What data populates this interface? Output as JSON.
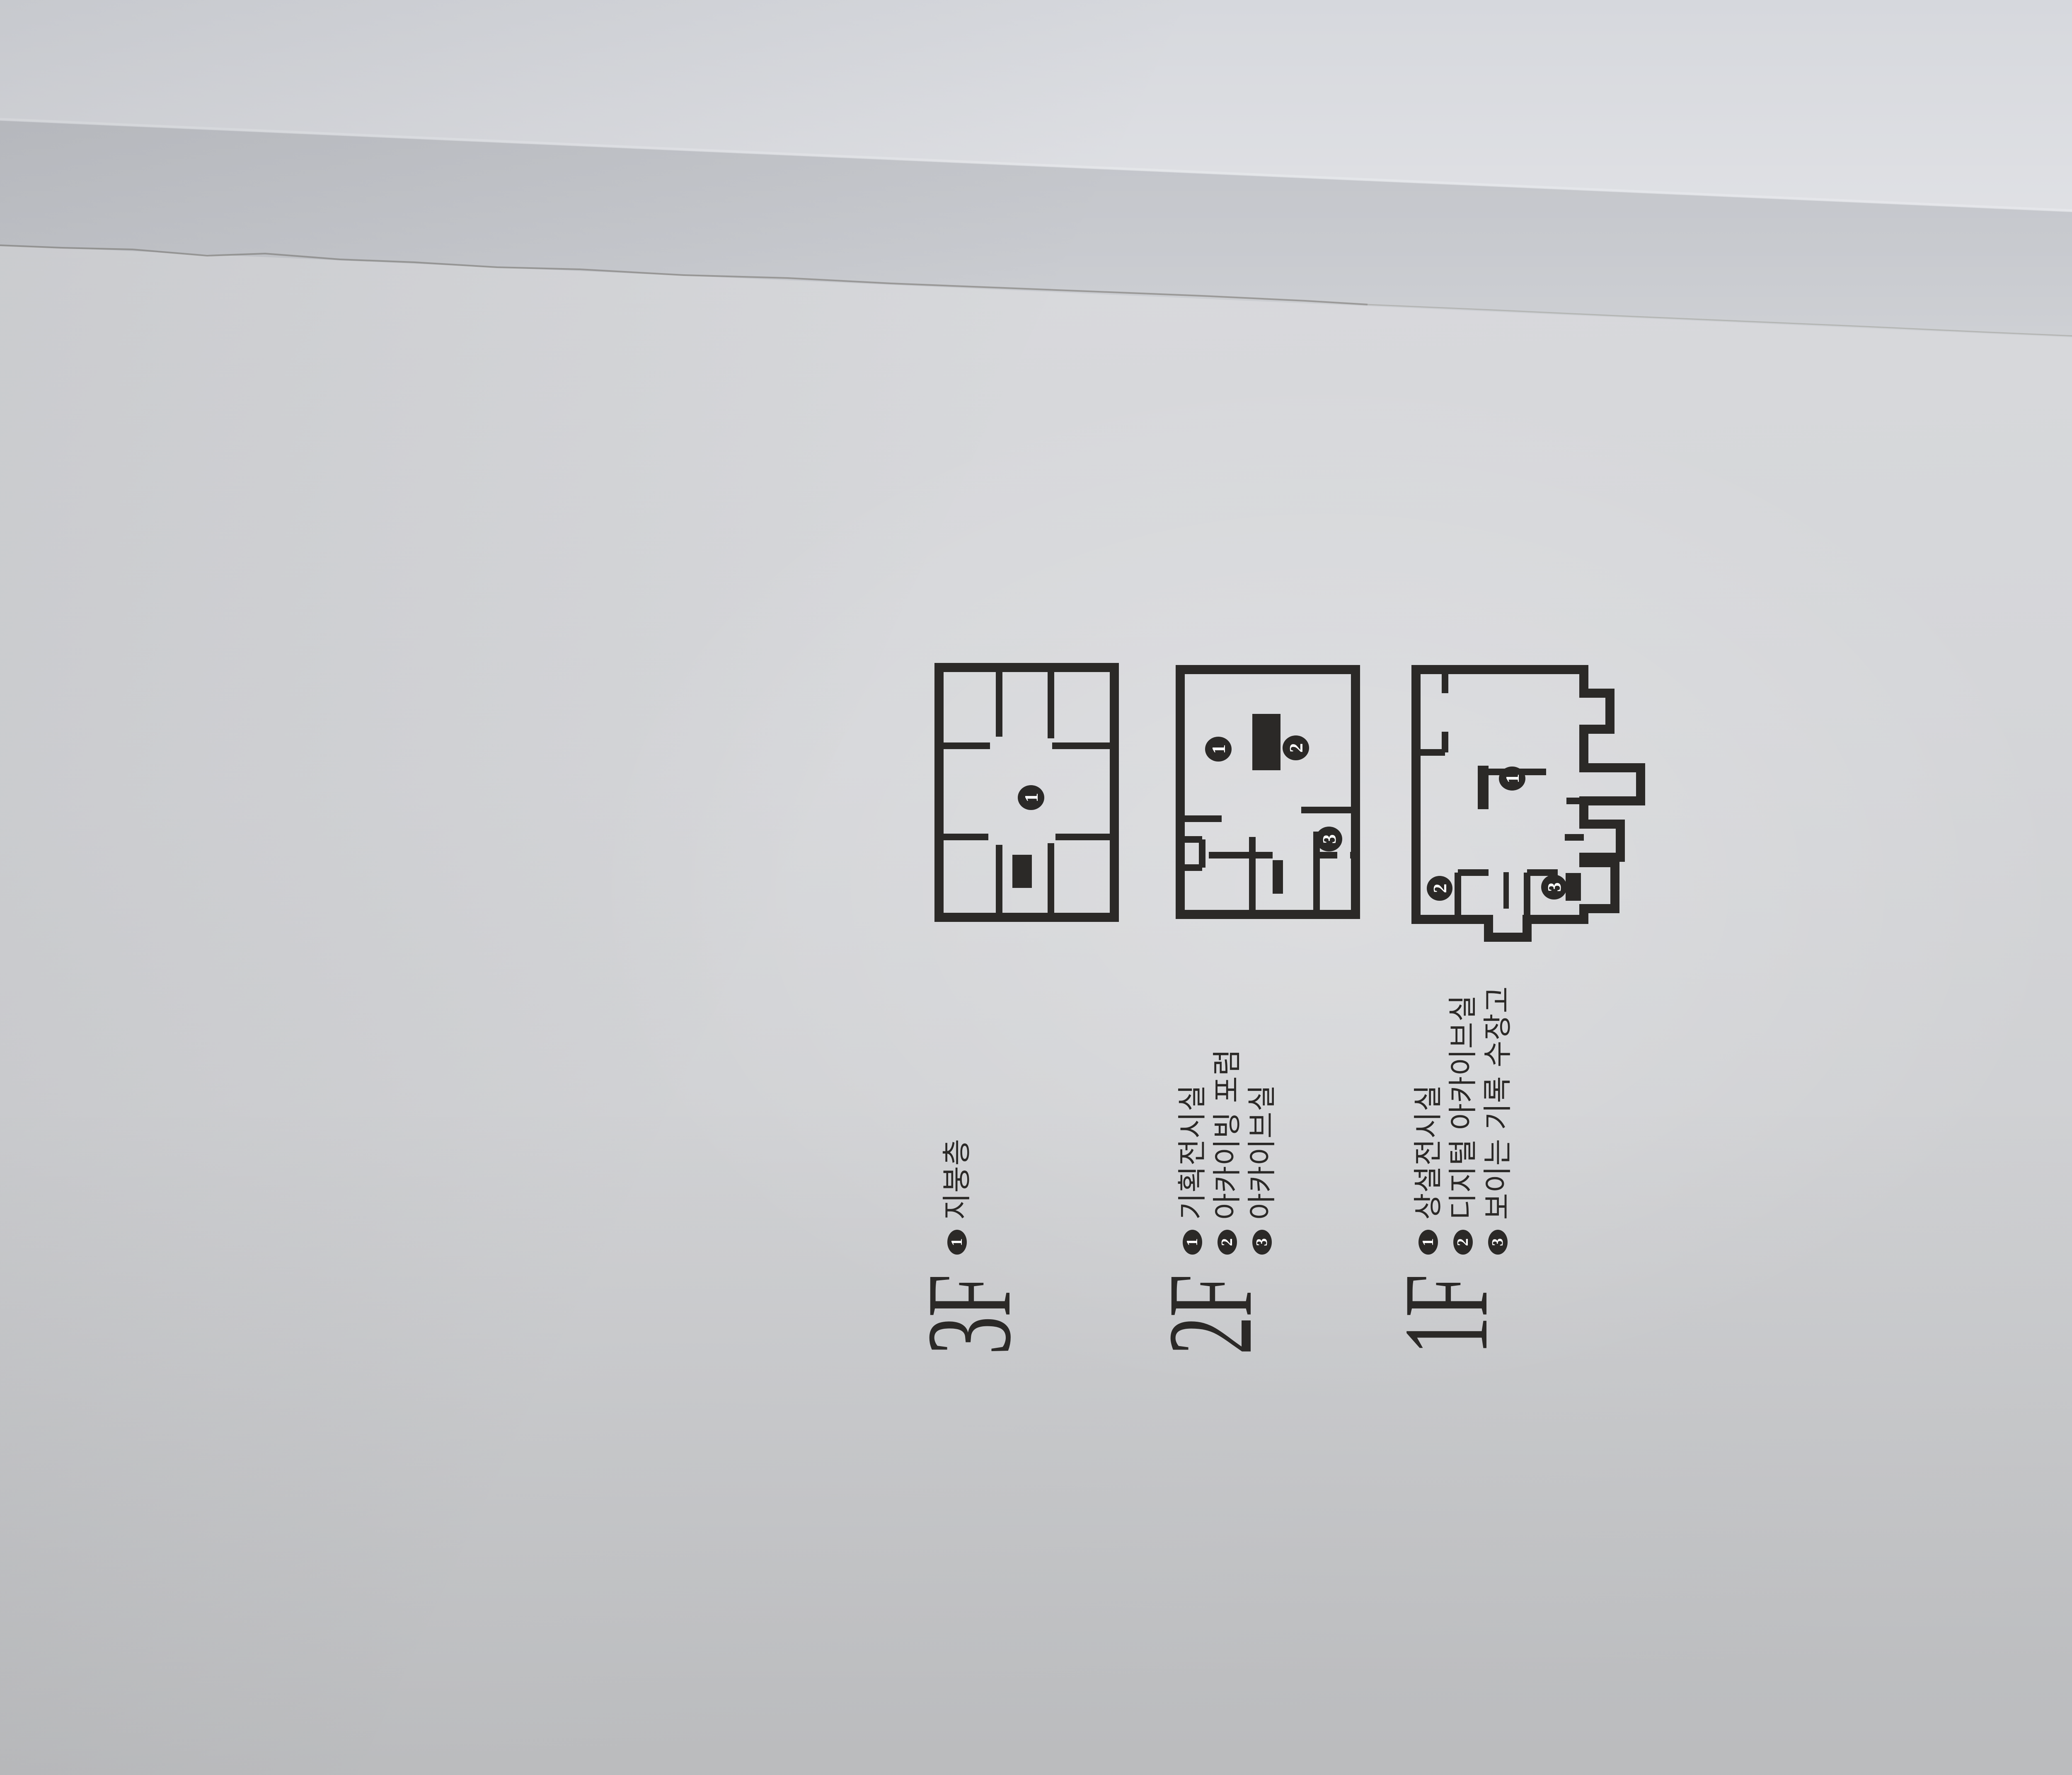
{
  "sign": {
    "ink_color": "#2b2927",
    "floors": [
      {
        "label": "3F",
        "rooms": [
          {
            "num": "1",
            "name": "지붕층"
          }
        ]
      },
      {
        "label": "2F",
        "rooms": [
          {
            "num": "1",
            "name": "기획전시실"
          },
          {
            "num": "2",
            "name": "아카이빙 포럼"
          },
          {
            "num": "3",
            "name": "아카이브실"
          }
        ]
      },
      {
        "label": "1F",
        "rooms": [
          {
            "num": "1",
            "name": "상설전시실"
          },
          {
            "num": "2",
            "name": "디지털 아카이브실"
          },
          {
            "num": "3",
            "name": "보이는 기록 수장고"
          }
        ]
      }
    ]
  },
  "wall": {
    "upper_color": "#dadce1",
    "beam_color": "#c6c8cd",
    "lower_color": "#d5d6d9",
    "crack_color": "#8e8d8b"
  }
}
